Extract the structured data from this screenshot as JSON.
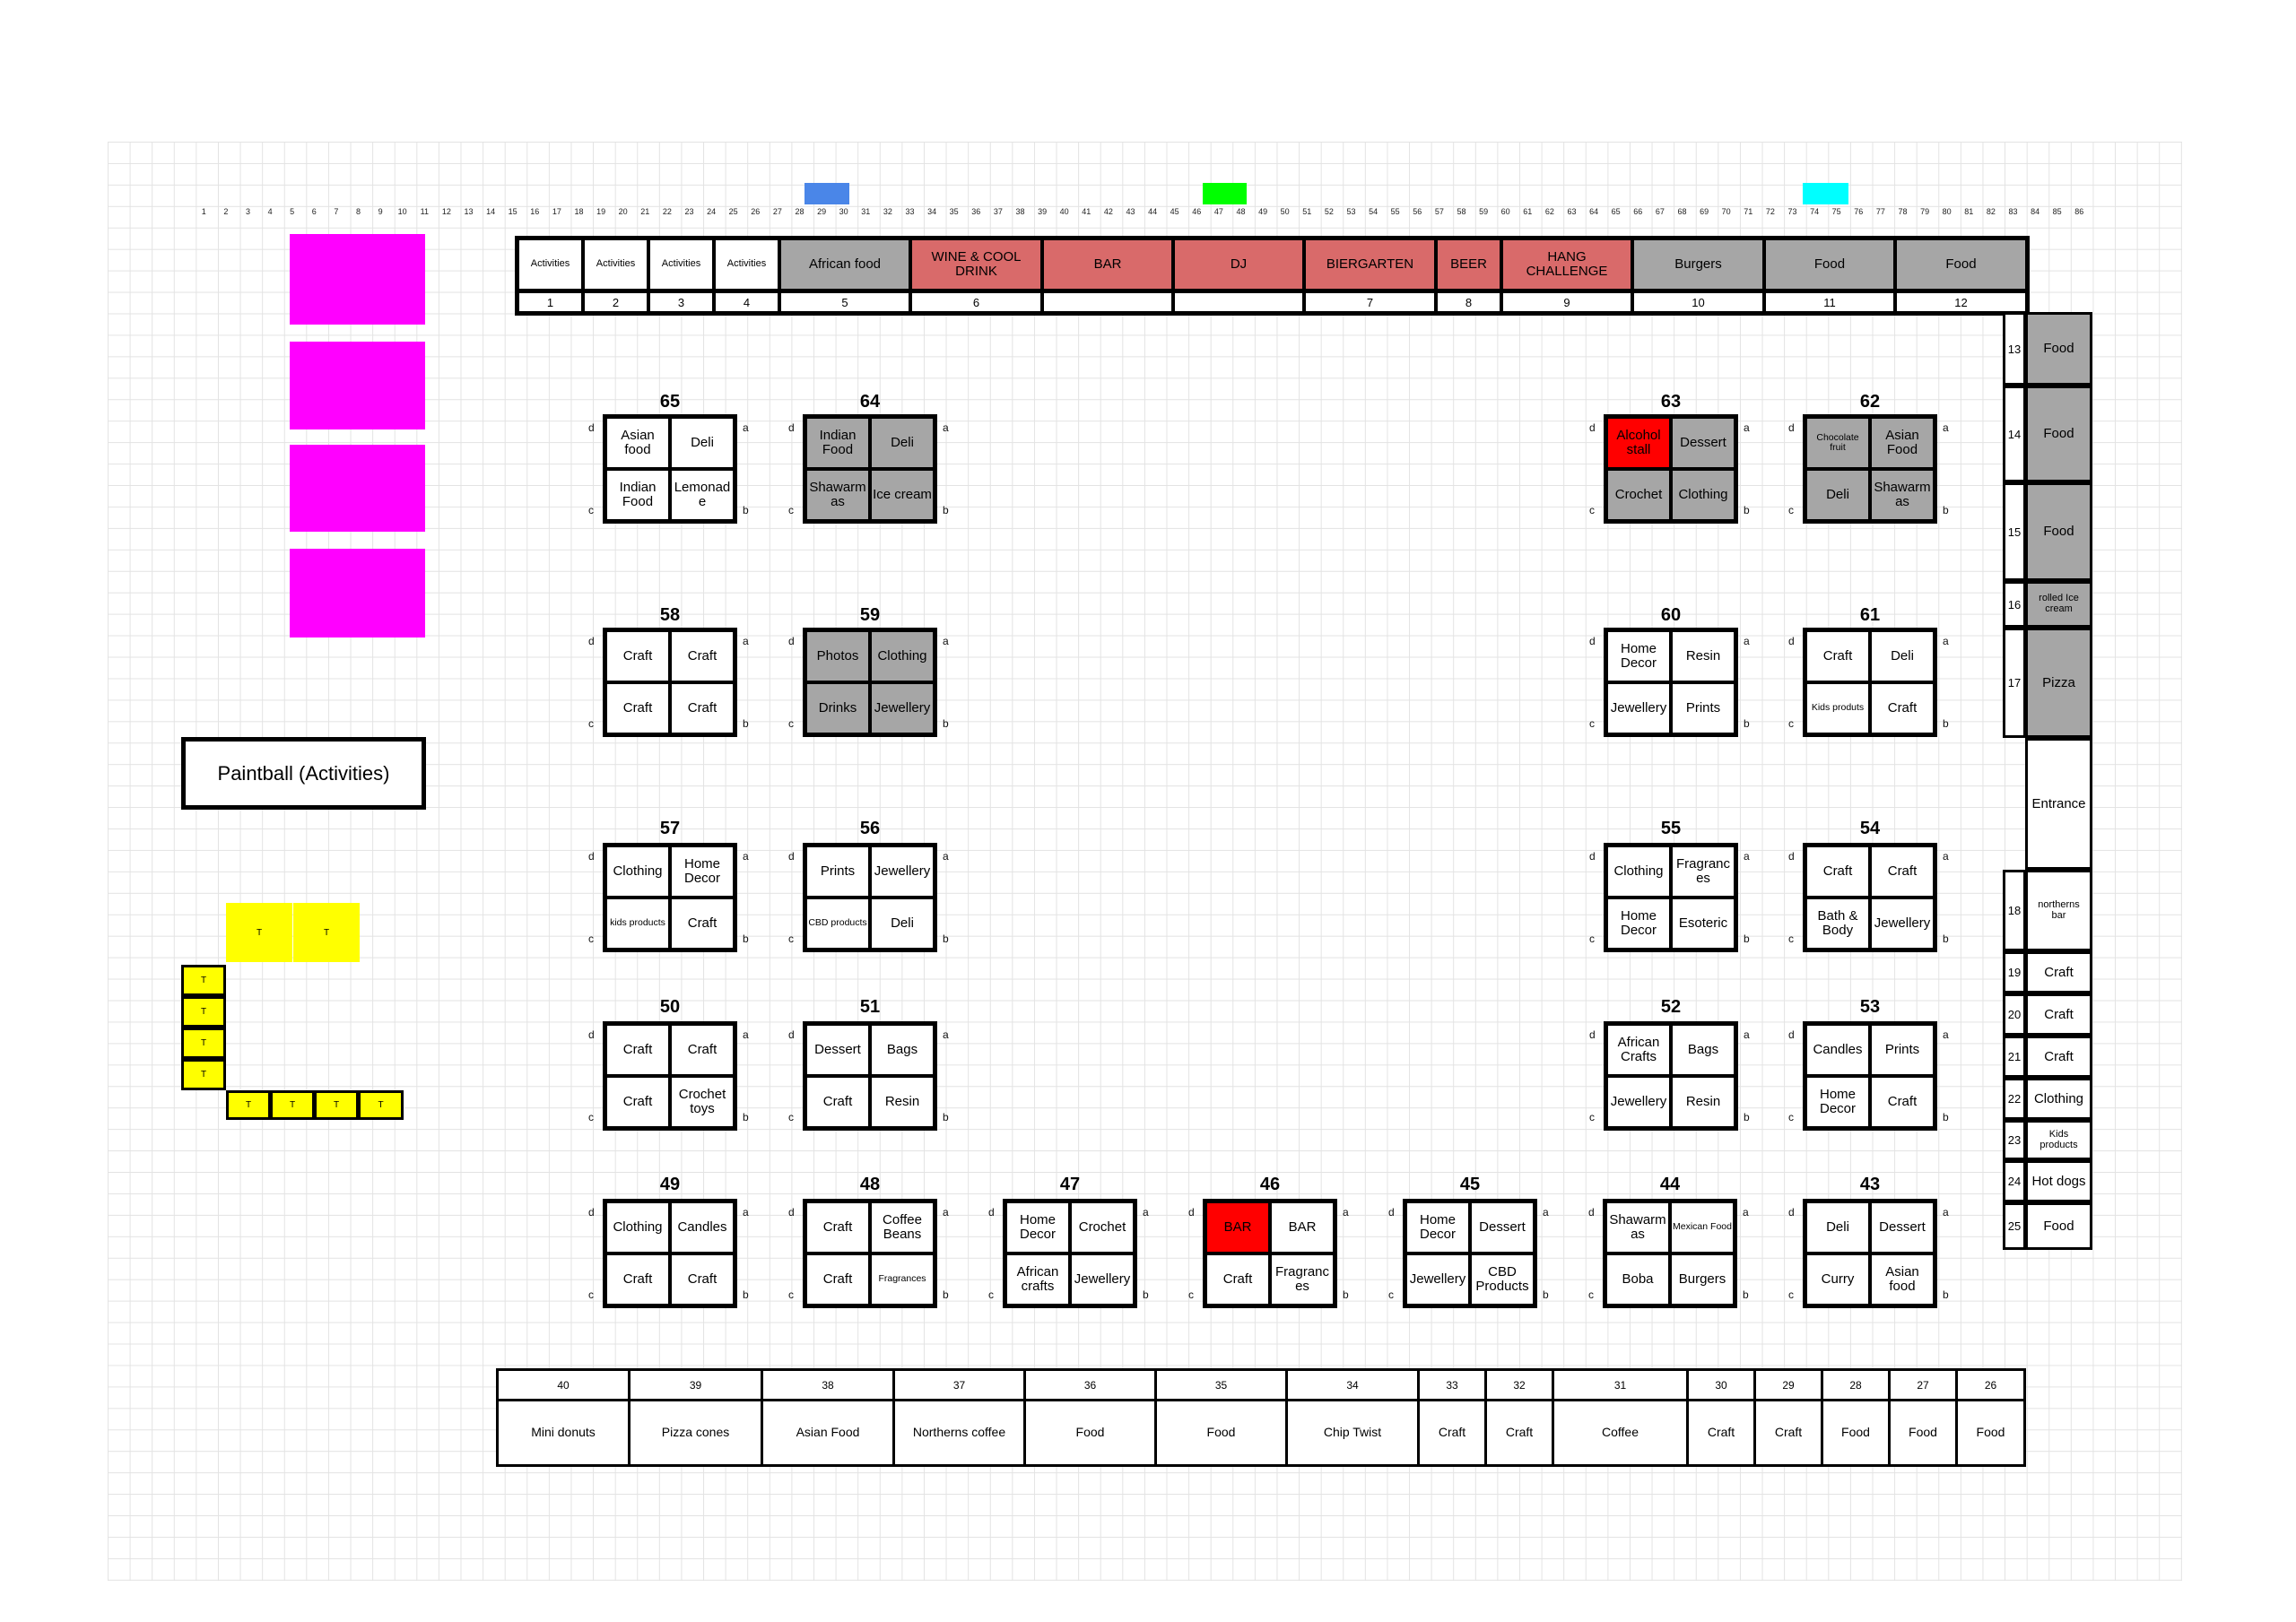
{
  "markers": {
    "blue": "#4a86e8",
    "green": "#00ff00",
    "cyan": "#00ffff",
    "magenta": "#ff00ff",
    "yellow": "#ffff00",
    "stall_red": "#ff0000",
    "banner_red": "#d96a6a",
    "gray": "#a6a6a6"
  },
  "paintball_label": "Paintball (Activities)",
  "table_label": "T",
  "corner_letters": {
    "top_left": "d",
    "top_right": "a",
    "bottom_left": "c",
    "bottom_right": "b"
  },
  "column_numbers": [
    "1",
    "2",
    "3",
    "4",
    "5",
    "6",
    "7",
    "8",
    "9",
    "10",
    "11",
    "12",
    "13",
    "14",
    "15",
    "16",
    "17",
    "18",
    "19",
    "20",
    "21",
    "22",
    "23",
    "24",
    "25",
    "26",
    "27",
    "28",
    "29",
    "30",
    "31",
    "32",
    "33",
    "34",
    "35",
    "36",
    "37",
    "38",
    "39",
    "40",
    "41",
    "42",
    "43",
    "44",
    "45",
    "46",
    "47",
    "48",
    "49",
    "50",
    "51",
    "52",
    "53",
    "54",
    "55",
    "56",
    "57",
    "58",
    "59",
    "60",
    "61",
    "62",
    "63",
    "64",
    "65",
    "66",
    "67",
    "68",
    "69",
    "70",
    "71",
    "72",
    "73",
    "74",
    "75",
    "76",
    "77",
    "78",
    "79",
    "80",
    "81",
    "82",
    "83",
    "84",
    "85",
    "86"
  ],
  "banner": {
    "cells": [
      {
        "label": "Activities",
        "number": "1",
        "color": "white"
      },
      {
        "label": "Activities",
        "number": "2",
        "color": "white"
      },
      {
        "label": "Activities",
        "number": "3",
        "color": "white"
      },
      {
        "label": "Activities",
        "number": "4",
        "color": "white"
      },
      {
        "label": "African food",
        "number": "5",
        "color": "gray"
      },
      {
        "label": "WINE & COOL DRINK",
        "number": "6",
        "color": "red"
      },
      {
        "label": "BAR",
        "number": "",
        "color": "red"
      },
      {
        "label": "DJ",
        "number": "",
        "color": "red"
      },
      {
        "label": "BIERGARTEN",
        "number": "7",
        "color": "red"
      },
      {
        "label": "BEER",
        "number": "8",
        "color": "red"
      },
      {
        "label": "HANG CHALLENGE",
        "number": "9",
        "color": "red"
      },
      {
        "label": "Burgers",
        "number": "10",
        "color": "gray"
      },
      {
        "label": "Food",
        "number": "11",
        "color": "gray"
      },
      {
        "label": "Food",
        "number": "12",
        "color": "gray"
      }
    ]
  },
  "stalls": {
    "65": {
      "cells": [
        {
          "label": "Asian food"
        },
        {
          "label": "Deli"
        },
        {
          "label": "Indian Food"
        },
        {
          "label": "Lemonade"
        }
      ]
    },
    "64": {
      "cells": [
        {
          "label": "Indian Food",
          "bg": "gray"
        },
        {
          "label": "Deli",
          "bg": "gray"
        },
        {
          "label": "Shawarmas",
          "bg": "gray"
        },
        {
          "label": "Ice cream",
          "bg": "gray"
        }
      ]
    },
    "63": {
      "cells": [
        {
          "label": "Alcohol stall",
          "bg": "red"
        },
        {
          "label": "Dessert",
          "bg": "gray"
        },
        {
          "label": "Crochet",
          "bg": "gray"
        },
        {
          "label": "Clothing",
          "bg": "gray"
        }
      ]
    },
    "62": {
      "cells": [
        {
          "label": "Chocolate fruit",
          "bg": "gray",
          "small": true
        },
        {
          "label": "Asian Food",
          "bg": "gray"
        },
        {
          "label": "Deli",
          "bg": "gray"
        },
        {
          "label": "Shawarmas",
          "bg": "gray"
        }
      ]
    },
    "58": {
      "cells": [
        {
          "label": "Craft"
        },
        {
          "label": "Craft"
        },
        {
          "label": "Craft"
        },
        {
          "label": "Craft"
        }
      ]
    },
    "59": {
      "cells": [
        {
          "label": "Photos",
          "bg": "gray"
        },
        {
          "label": "Clothing",
          "bg": "gray"
        },
        {
          "label": "Drinks",
          "bg": "gray"
        },
        {
          "label": "Jewellery",
          "bg": "gray"
        }
      ]
    },
    "60": {
      "cells": [
        {
          "label": "Home Decor"
        },
        {
          "label": "Resin"
        },
        {
          "label": "Jewellery"
        },
        {
          "label": "Prints"
        }
      ]
    },
    "61": {
      "cells": [
        {
          "label": "Craft"
        },
        {
          "label": "Deli"
        },
        {
          "label": "Kids produts",
          "small": true
        },
        {
          "label": "Craft"
        }
      ]
    },
    "57": {
      "cells": [
        {
          "label": "Clothing"
        },
        {
          "label": "Home Decor"
        },
        {
          "label": "kids products",
          "small": true
        },
        {
          "label": "Craft"
        }
      ]
    },
    "56": {
      "cells": [
        {
          "label": "Prints"
        },
        {
          "label": "Jewellery"
        },
        {
          "label": "CBD products",
          "small": true
        },
        {
          "label": "Deli"
        }
      ]
    },
    "55": {
      "cells": [
        {
          "label": "Clothing"
        },
        {
          "label": "Fragrances"
        },
        {
          "label": "Home Decor"
        },
        {
          "label": "Esoteric"
        }
      ]
    },
    "54": {
      "cells": [
        {
          "label": "Craft"
        },
        {
          "label": "Craft"
        },
        {
          "label": "Bath & Body"
        },
        {
          "label": "Jewellery"
        }
      ]
    },
    "50": {
      "cells": [
        {
          "label": "Craft"
        },
        {
          "label": "Craft"
        },
        {
          "label": "Craft"
        },
        {
          "label": "Crochet toys"
        }
      ]
    },
    "51": {
      "cells": [
        {
          "label": "Dessert"
        },
        {
          "label": "Bags"
        },
        {
          "label": "Craft"
        },
        {
          "label": "Resin"
        }
      ]
    },
    "52": {
      "cells": [
        {
          "label": "African Crafts"
        },
        {
          "label": "Bags"
        },
        {
          "label": "Jewellery"
        },
        {
          "label": "Resin"
        }
      ]
    },
    "53": {
      "cells": [
        {
          "label": "Candles"
        },
        {
          "label": "Prints"
        },
        {
          "label": "Home Decor"
        },
        {
          "label": "Craft"
        }
      ]
    },
    "49": {
      "cells": [
        {
          "label": "Clothing"
        },
        {
          "label": "Candles"
        },
        {
          "label": "Craft"
        },
        {
          "label": "Craft"
        }
      ]
    },
    "48": {
      "cells": [
        {
          "label": "Craft"
        },
        {
          "label": "Coffee Beans"
        },
        {
          "label": "Craft"
        },
        {
          "label": "Fragrances",
          "small": true
        }
      ]
    },
    "47": {
      "cells": [
        {
          "label": "Home Decor"
        },
        {
          "label": "Crochet"
        },
        {
          "label": "African crafts"
        },
        {
          "label": "Jewellery"
        }
      ]
    },
    "46": {
      "cells": [
        {
          "label": "BAR",
          "bg": "red"
        },
        {
          "label": "BAR"
        },
        {
          "label": "Craft"
        },
        {
          "label": "Fragrances"
        }
      ]
    },
    "45": {
      "cells": [
        {
          "label": "Home Decor"
        },
        {
          "label": "Dessert"
        },
        {
          "label": "Jewellery"
        },
        {
          "label": "CBD Products"
        }
      ]
    },
    "44": {
      "cells": [
        {
          "label": "Shawarmas"
        },
        {
          "label": "Mexican Food",
          "small": true
        },
        {
          "label": "Boba"
        },
        {
          "label": "Burgers"
        }
      ]
    },
    "43": {
      "cells": [
        {
          "label": "Deli"
        },
        {
          "label": "Dessert"
        },
        {
          "label": "Curry"
        },
        {
          "label": "Asian food"
        }
      ]
    }
  },
  "right_column": [
    {
      "number": "13",
      "label": "Food",
      "bg": "gray"
    },
    {
      "number": "14",
      "label": "Food",
      "bg": "gray"
    },
    {
      "number": "15",
      "label": "Food",
      "bg": "gray"
    },
    {
      "number": "16",
      "label": "rolled Ice cream",
      "bg": "gray",
      "small": true
    },
    {
      "number": "17",
      "label": "Pizza",
      "bg": "gray"
    },
    {
      "number": "",
      "label": "Entrance"
    },
    {
      "number": "18",
      "label": "northerns bar",
      "small": true
    },
    {
      "number": "19",
      "label": "Craft"
    },
    {
      "number": "20",
      "label": "Craft"
    },
    {
      "number": "21",
      "label": "Craft"
    },
    {
      "number": "22",
      "label": "Clothing"
    },
    {
      "number": "23",
      "label": "Kids products",
      "small": true
    },
    {
      "number": "24",
      "label": "Hot dogs"
    },
    {
      "number": "25",
      "label": "Food"
    }
  ],
  "bottom_row": [
    {
      "number": "40",
      "label": "Mini donuts"
    },
    {
      "number": "39",
      "label": "Pizza cones"
    },
    {
      "number": "38",
      "label": "Asian Food"
    },
    {
      "number": "37",
      "label": "Northerns coffee"
    },
    {
      "number": "36",
      "label": "Food"
    },
    {
      "number": "35",
      "label": "Food"
    },
    {
      "number": "34",
      "label": "Chip Twist"
    },
    {
      "number": "33",
      "label": "Craft"
    },
    {
      "number": "32",
      "label": "Craft"
    },
    {
      "number": "31",
      "label": "Coffee"
    },
    {
      "number": "30",
      "label": "Craft"
    },
    {
      "number": "29",
      "label": "Craft"
    },
    {
      "number": "28",
      "label": "Food"
    },
    {
      "number": "27",
      "label": "Food"
    },
    {
      "number": "26",
      "label": "Food"
    }
  ]
}
